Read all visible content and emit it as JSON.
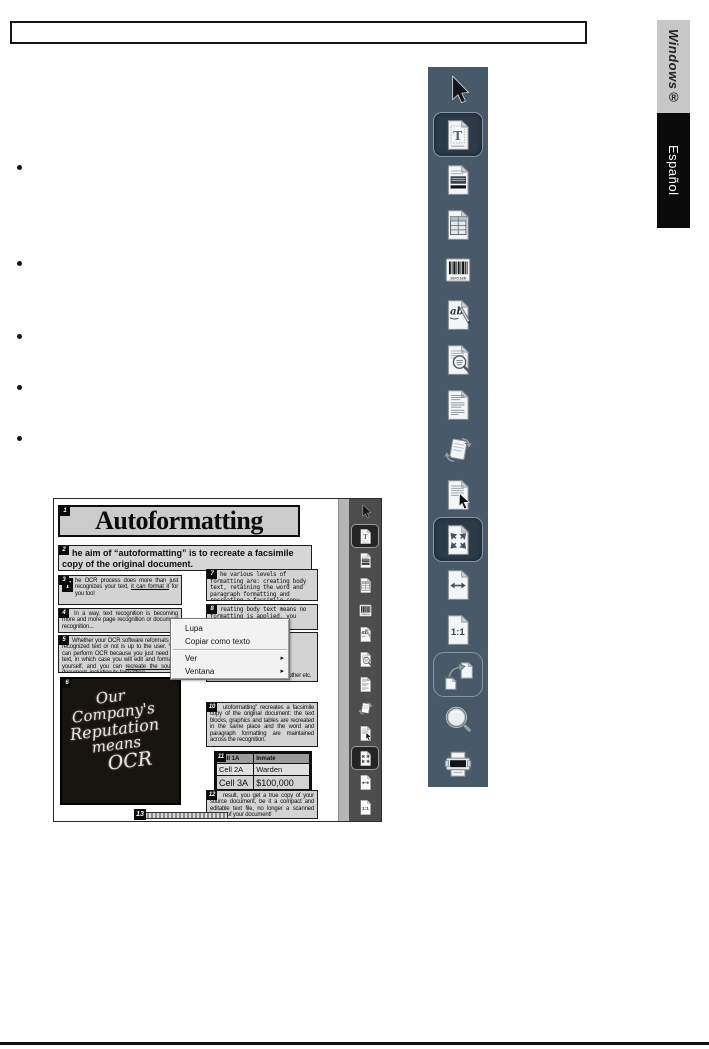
{
  "colors": {
    "toolbar_bg": "#48596a",
    "toolbar_selected_bg": "#2c3b48",
    "toolbar_outline": "#8796a1",
    "tab_windows_bg": "#c7c7c7",
    "tab_espanol_bg": "#0a0a0a",
    "mini_toolbar_bg": "#4d4d4d"
  },
  "tabs": {
    "windows": "Windows®",
    "language": "Español"
  },
  "bullets": {
    "count": 5
  },
  "toolbar": {
    "items": [
      {
        "name": "pointer-cursor",
        "state": "normal"
      },
      {
        "name": "page-text",
        "state": "selected"
      },
      {
        "name": "page-stripes",
        "state": "normal"
      },
      {
        "name": "page-table",
        "state": "normal"
      },
      {
        "name": "barcode",
        "state": "normal"
      },
      {
        "name": "page-handwriting",
        "state": "normal"
      },
      {
        "name": "page-magnifier",
        "state": "normal"
      },
      {
        "name": "page-paragraphs",
        "state": "normal"
      },
      {
        "name": "clipboard-sync",
        "state": "normal"
      },
      {
        "name": "page-cursor",
        "state": "normal"
      },
      {
        "name": "page-fit",
        "state": "selected"
      },
      {
        "name": "page-fit-width",
        "state": "normal"
      },
      {
        "name": "page-actual-size",
        "state": "normal"
      },
      {
        "name": "pages-export",
        "state": "outlined"
      },
      {
        "name": "magnifier",
        "state": "normal"
      },
      {
        "name": "printer",
        "state": "normal"
      }
    ]
  },
  "screenshot": {
    "context_menu": {
      "items": [
        {
          "label": "Lupa",
          "has_submenu": false
        },
        {
          "label": "Copiar como texto",
          "has_submenu": false
        },
        {
          "label": "Ver",
          "has_submenu": true
        },
        {
          "label": "Ventana",
          "has_submenu": true
        }
      ]
    },
    "mini_toolbar": {
      "items": [
        {
          "name": "pointer-cursor",
          "state": "normal"
        },
        {
          "name": "page-text",
          "state": "selected"
        },
        {
          "name": "page-stripes",
          "state": "normal"
        },
        {
          "name": "page-table",
          "state": "normal"
        },
        {
          "name": "barcode",
          "state": "normal"
        },
        {
          "name": "page-handwriting",
          "state": "normal"
        },
        {
          "name": "page-magnifier",
          "state": "normal"
        },
        {
          "name": "page-paragraphs",
          "state": "normal"
        },
        {
          "name": "clipboard-sync",
          "state": "normal"
        },
        {
          "name": "page-cursor",
          "state": "normal"
        },
        {
          "name": "page-fit",
          "state": "selected"
        },
        {
          "name": "page-fit-width",
          "state": "normal"
        },
        {
          "name": "page-actual-size",
          "state": "normal"
        }
      ]
    },
    "document": {
      "blocks": {
        "b1": {
          "marker": "1",
          "title": "Autoformatting"
        },
        "b2": {
          "marker": "2",
          "text": "he aim of “autoformatting” is to recreate a facsimile copy of the original document."
        },
        "b3": {
          "marker": "3",
          "dropcap": "T",
          "pre": "he OCR process does more than just recognizes your text, ",
          "underlined": "it can format it",
          "post": " for you too!"
        },
        "b4": {
          "marker": "4",
          "text": "In a way, text recognition is becoming more and more page recognition or document recognition..."
        },
        "b5": {
          "marker": "5",
          "pre": "Whether your OCR software reformats the recognized text or not is up to the user. You can perform OCR because you just need the text, in which case you will edit and format it yourself, and you can ",
          "underlined": "recreate the source document",
          "post": ", including its formatting."
        },
        "b6": {
          "marker": "6",
          "lines": [
            "Our",
            "Company's",
            "Reputation",
            "means",
            "OCR"
          ]
        },
        "b7": {
          "marker": "7",
          "text": "he various levels of formatting are: creating body text, retaining the word and paragraph formatting and recreating a facsimile copy."
        },
        "b8": {
          "marker": "8",
          "text": "reating body text means no formatting is applied, you"
        },
        "b9": {
          "text": "the paragraphs just follow each other etc."
        },
        "b10": {
          "marker": "10",
          "text": "utoformatting” recreates a facsimile copy of the original document: the text blocks, graphics and tables are recreated in the same place and the word and paragraph formatting are maintained across the recognition."
        },
        "b11": {
          "marker": "11",
          "rows": [
            [
              "Cell 1A",
              "Inmate"
            ],
            [
              "Cell 2A",
              "Warden"
            ],
            [
              "Cell 3A",
              "$100,000"
            ]
          ]
        },
        "b12": {
          "marker": "12",
          "text": "result, you get a true copy of your source document, be it a compact and editable text file, no longer a scanned image of your document!"
        },
        "b13": {
          "marker": "13"
        }
      }
    }
  }
}
